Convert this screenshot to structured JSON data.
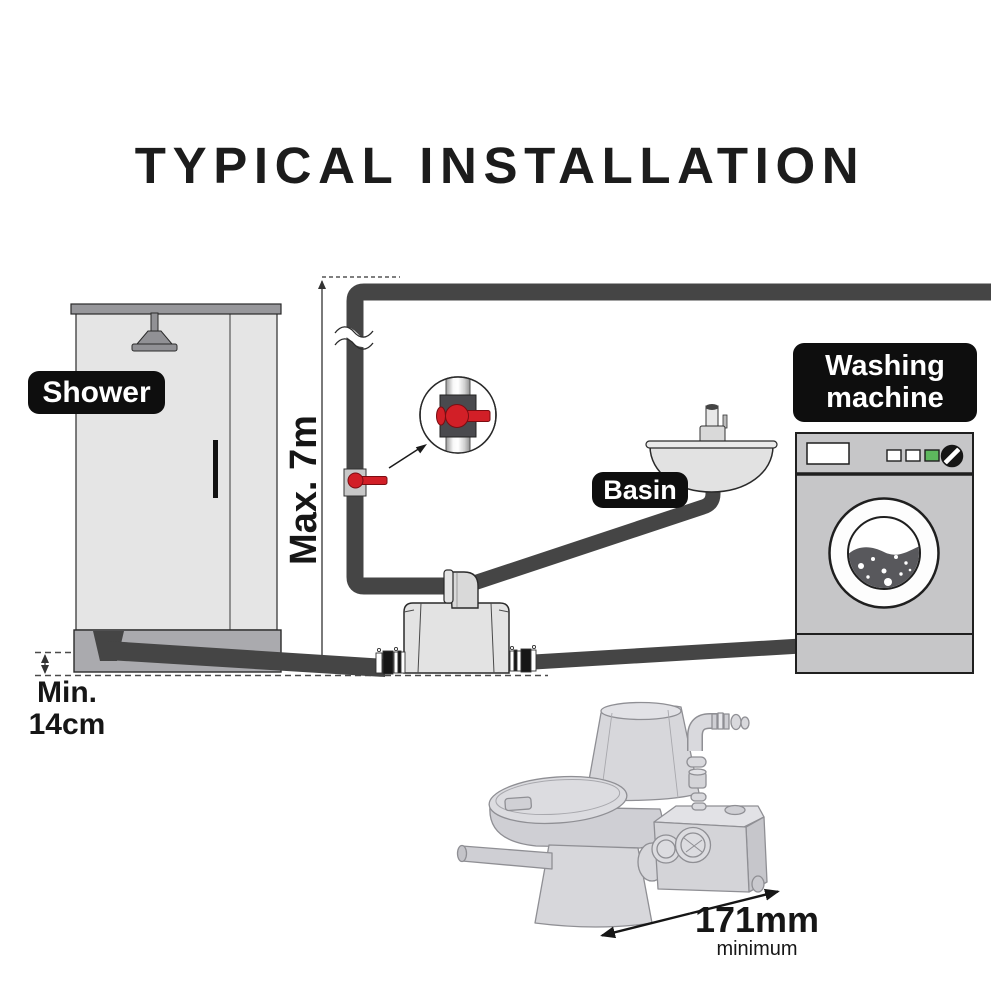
{
  "title": "TYPICAL INSTALLATION",
  "labels": {
    "shower": "Shower",
    "basin": "Basin",
    "washing_machine": {
      "line1": "Washing",
      "line2": "machine"
    },
    "max_height": "Max. 7m",
    "min_clearance": {
      "line1": "Min.",
      "line2": "14cm"
    },
    "footprint": {
      "value": "171mm",
      "qualifier": "minimum"
    }
  },
  "colors": {
    "pipe": "#454545",
    "valve-red": "#d21f27",
    "label-bg": "#0e0e0e",
    "label-text": "#ffffff",
    "ink": "#161616",
    "fixture-light": "#e5e5e5",
    "fixture-mid": "#c6c6c8",
    "fixture-dark": "#aaaaae",
    "sketch-fill": "#d7d7db",
    "sketch-line": "#8f8f94",
    "green-button": "#5db75d"
  }
}
